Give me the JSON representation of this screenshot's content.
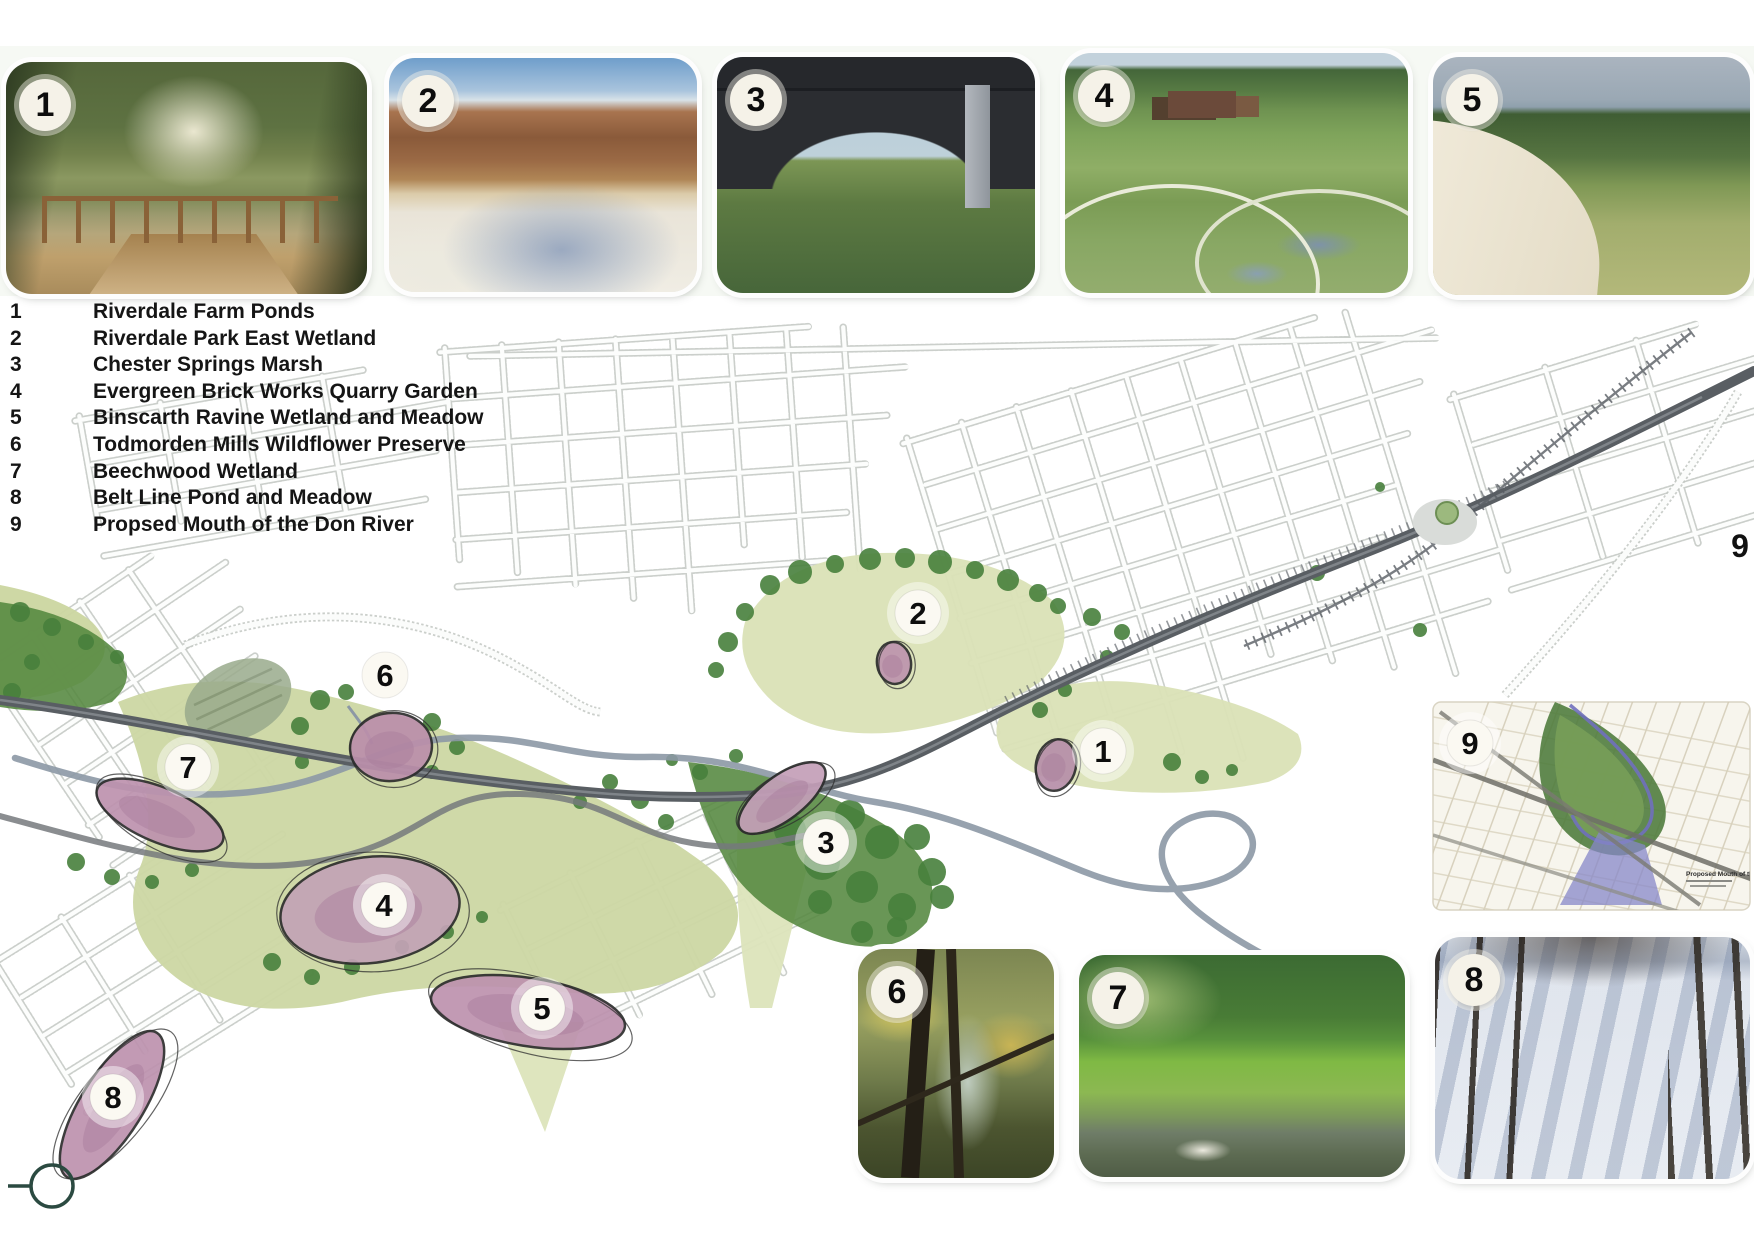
{
  "page": {
    "background": "#ffffff"
  },
  "legend": {
    "items": [
      {
        "num": "1",
        "label": "Riverdale Farm Ponds"
      },
      {
        "num": "2",
        "label": "Riverdale Park East Wetland"
      },
      {
        "num": "3",
        "label": "Chester Springs Marsh"
      },
      {
        "num": "4",
        "label": "Evergreen Brick Works Quarry Garden"
      },
      {
        "num": "5",
        "label": "Binscarth Ravine Wetland and Meadow"
      },
      {
        "num": "6",
        "label": "Todmorden Mills Wildflower Preserve"
      },
      {
        "num": "7",
        "label": "Beechwood Wetland"
      },
      {
        "num": "8",
        "label": "Belt Line Pond and Meadow"
      },
      {
        "num": "9",
        "label": "Propsed Mouth of the Don River"
      }
    ]
  },
  "photos": {
    "top": [
      {
        "num": "1"
      },
      {
        "num": "2"
      },
      {
        "num": "3"
      },
      {
        "num": "4"
      },
      {
        "num": "5"
      }
    ],
    "bottom": [
      {
        "num": "6"
      },
      {
        "num": "7"
      },
      {
        "num": "8"
      }
    ]
  },
  "map": {
    "markers": [
      {
        "num": "1"
      },
      {
        "num": "2"
      },
      {
        "num": "3"
      },
      {
        "num": "4"
      },
      {
        "num": "5"
      },
      {
        "num": "6"
      },
      {
        "num": "7"
      },
      {
        "num": "8"
      },
      {
        "num": "9"
      }
    ],
    "edge_label": "9",
    "inset": {
      "badge": "9",
      "caption": "Proposed Mouth of the Don River"
    },
    "colors": {
      "site_fill": "#c29db6",
      "highway": "#595e63",
      "river": "#8c98a5",
      "green_dark": "#54883f",
      "green_light": "#d2dcab"
    }
  }
}
